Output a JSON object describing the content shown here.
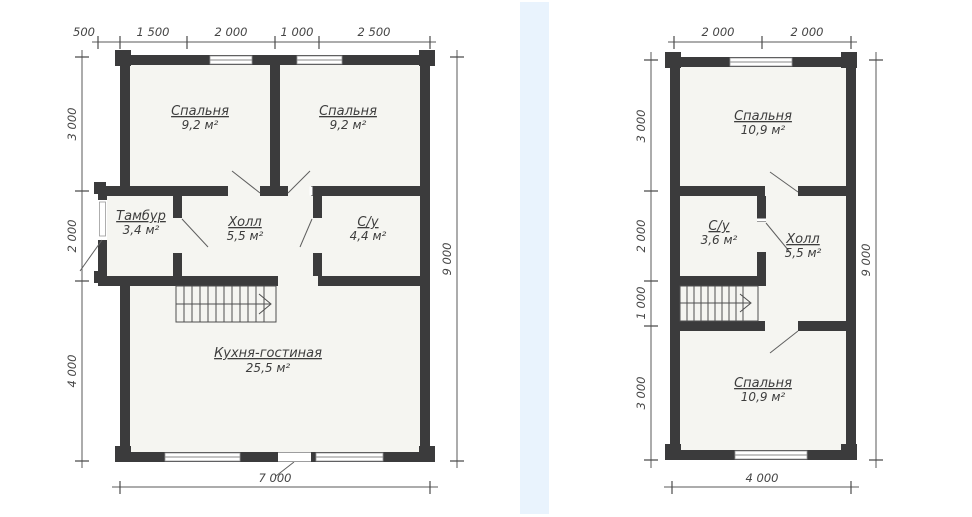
{
  "page": {
    "kind": "architectural-floor-plans"
  },
  "colors": {
    "wall": "#3b3b3c",
    "room_fill": "#f5f5f1",
    "background": "#ffffff",
    "stripe": "#e9f3fd",
    "line": "#5a5a5a",
    "text": "#3d3d3d"
  },
  "floor1": {
    "rooms": {
      "bedroom_left": {
        "name": "Спальня",
        "area": "9,2 м²"
      },
      "bedroom_right": {
        "name": "Спальня",
        "area": "9,2 м²"
      },
      "tambour": {
        "name": "Тамбур",
        "area": "3,4 м²"
      },
      "hall": {
        "name": "Холл",
        "area": "5,5 м²"
      },
      "bathroom": {
        "name": "С/у",
        "area": "4,4 м²"
      },
      "kitchen": {
        "name": "Кухня-гостиная",
        "area": "25,5 м²"
      }
    },
    "dims": {
      "top": [
        "500",
        "1 500",
        "2 000",
        "1 000",
        "2 500"
      ],
      "left": [
        "3 000",
        "2 000",
        "4 000"
      ],
      "right": "9 000",
      "bottom": "7 000"
    }
  },
  "floor2": {
    "rooms": {
      "bedroom_top": {
        "name": "Спальня",
        "area": "10,9 м²"
      },
      "bathroom": {
        "name": "С/у",
        "area": "3,6 м²"
      },
      "hall": {
        "name": "Холл",
        "area": "5,5 м²"
      },
      "bedroom_bottom": {
        "name": "Спальня",
        "area": "10,9 м²"
      }
    },
    "dims": {
      "top": [
        "2 000",
        "2 000"
      ],
      "left": [
        "3 000",
        "2 000",
        "1 000",
        "3 000"
      ],
      "right": "9 000",
      "bottom": "4 000"
    }
  }
}
